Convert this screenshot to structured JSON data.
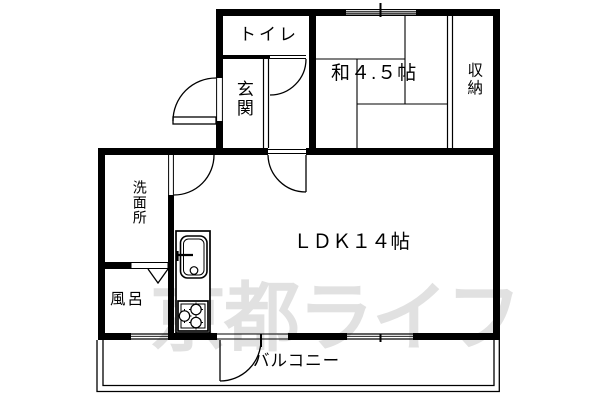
{
  "floorplan": {
    "colors": {
      "background": "#ffffff",
      "wall": "#000000",
      "watermark": "#e1e1e1"
    },
    "rooms": {
      "toilet": {
        "label": "トイレ"
      },
      "entrance": {
        "label": "玄関"
      },
      "japanese_room": {
        "label": "和４.５帖"
      },
      "closet": {
        "label": "収納"
      },
      "washroom": {
        "label": "洗面所"
      },
      "bath": {
        "label": "風呂"
      },
      "ldk": {
        "label": "ＬＤＫ１４帖"
      },
      "balcony": {
        "label": "バルコニー"
      }
    },
    "watermark": {
      "text": "京都ライフ"
    }
  }
}
